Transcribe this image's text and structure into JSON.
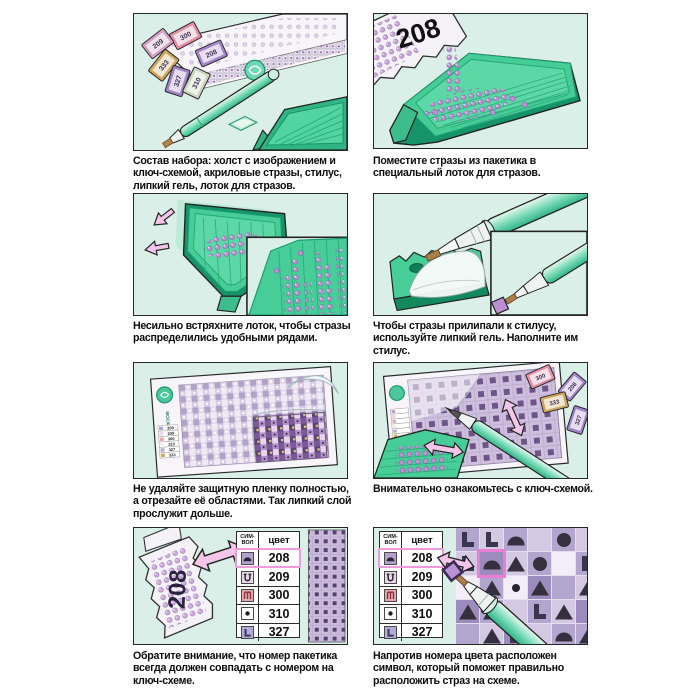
{
  "colors": {
    "panel_bg": "#d9efe8",
    "tray_green": "#47cd97",
    "tray_dark": "#17936a",
    "highlight_pink": "#e97fd5",
    "arrow_pink": "#f3c6e9",
    "rhinestone_purple": "#bb93cf",
    "stylus_teal": "#3fc291"
  },
  "brand": "МОСФА",
  "packets": {
    "p208": "208",
    "p209": "209",
    "p300": "300",
    "p310": "310",
    "p327": "327",
    "p333": "333"
  },
  "mini_key": [
    "208",
    "209",
    "300",
    "310",
    "327",
    "333"
  ],
  "panels": [
    {
      "caption": "Состав набора: холст с изображением и ключ-схемой, акриловые стразы, стилус, липкий гель, лоток для стразов."
    },
    {
      "caption": "Поместите стразы из пакетика в специальный лоток для стразов."
    },
    {
      "caption": "Несильно встряхните лоток, чтобы стразы распределились удобными рядами."
    },
    {
      "caption": "Чтобы стразы прилипали к стилусу, используйте липкий гель. Наполните им стилус."
    },
    {
      "caption": "Не удаляйте защитную пленку полностью, а отрезайте её областями. Так липкий слой прослужит дольше."
    },
    {
      "caption": "Внимательно ознакомьтесь с ключ-схемой."
    },
    {
      "caption": "Обратите внимание, что номер пакетика всегда должен совпадать с номером на ключ-схеме."
    },
    {
      "caption": "Напротив номера цвета расположен символ, который поможет правильно расположить страз на схеме."
    }
  ],
  "key_table": {
    "headers": {
      "symbol": "СИМ-ВОЛ",
      "color": "цвет"
    },
    "rows": [
      {
        "symbol": "dome",
        "color": "208",
        "highlight": true,
        "sym_style": "background:#b4a0cf"
      },
      {
        "symbol": "hook",
        "color": "209",
        "highlight": false,
        "sym_style": "background:#e8d7e6"
      },
      {
        "symbol": "arches",
        "color": "300",
        "highlight": false,
        "sym_style": "background:#e2a9ae"
      },
      {
        "symbol": "dot",
        "color": "310",
        "highlight": false,
        "sym_style": "background:#ffffff"
      },
      {
        "symbol": "L",
        "color": "327",
        "highlight": false,
        "sym_style": "background:#b3abd5"
      }
    ]
  },
  "panel8": {
    "grid": {
      "shades": {
        "A": "#b3a6ce",
        "B": "#d3c9e2",
        "C": "#9c8bbd",
        "W": "#f2edf6"
      },
      "highlight": [
        1,
        1
      ],
      "rows": [
        [
          [
            "L",
            "A"
          ],
          [
            "L",
            "B"
          ],
          [
            "dome",
            "A"
          ],
          [
            "none",
            "B"
          ],
          [
            "circle",
            "A"
          ],
          [
            "none",
            "B"
          ]
        ],
        [
          [
            "L",
            "B"
          ],
          [
            "dome",
            "C"
          ],
          [
            "tri",
            "B"
          ],
          [
            "circle",
            "A"
          ],
          [
            "none",
            "W"
          ],
          [
            "L",
            "A"
          ]
        ],
        [
          [
            "none",
            "W"
          ],
          [
            "tri",
            "A"
          ],
          [
            "dot",
            "W"
          ],
          [
            "tri",
            "C"
          ],
          [
            "none",
            "A"
          ],
          [
            "tri",
            "B"
          ]
        ],
        [
          [
            "tri",
            "C"
          ],
          [
            "tri",
            "A"
          ],
          [
            "none",
            "B"
          ],
          [
            "L",
            "A"
          ],
          [
            "tri",
            "B"
          ],
          [
            "none",
            "C"
          ]
        ],
        [
          [
            "none",
            "A"
          ],
          [
            "tri",
            "B"
          ],
          [
            "L",
            "C"
          ],
          [
            "none",
            "B"
          ],
          [
            "dome",
            "A"
          ],
          [
            "tri",
            "A"
          ]
        ]
      ]
    }
  }
}
